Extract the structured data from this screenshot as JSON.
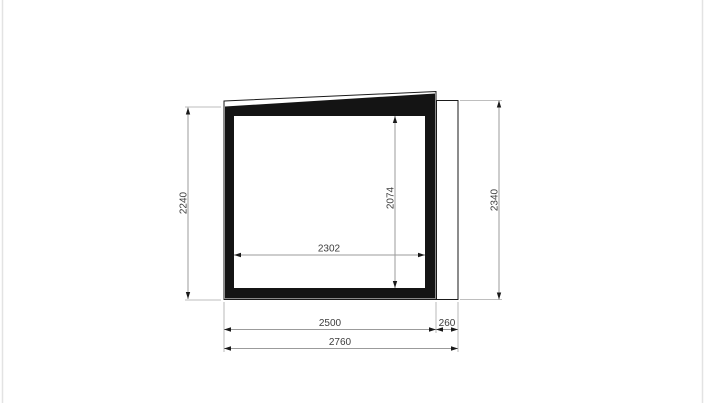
{
  "page": {
    "background": "#ffffff",
    "canvas_edge_color": "#e3e3e3"
  },
  "drawing": {
    "type": "technical-elevation-drawing",
    "structure_color": "#141414",
    "outline_color": "#1a1a1a",
    "dim_line_color": "#9b9b9b",
    "dim_text_color": "#3d3d3d",
    "dimensions": {
      "left_height": "2240",
      "inner_height": "2074",
      "right_height": "2340",
      "inner_width": "2302",
      "body_width": "2500",
      "extension_width": "260",
      "total_width": "2760"
    }
  }
}
